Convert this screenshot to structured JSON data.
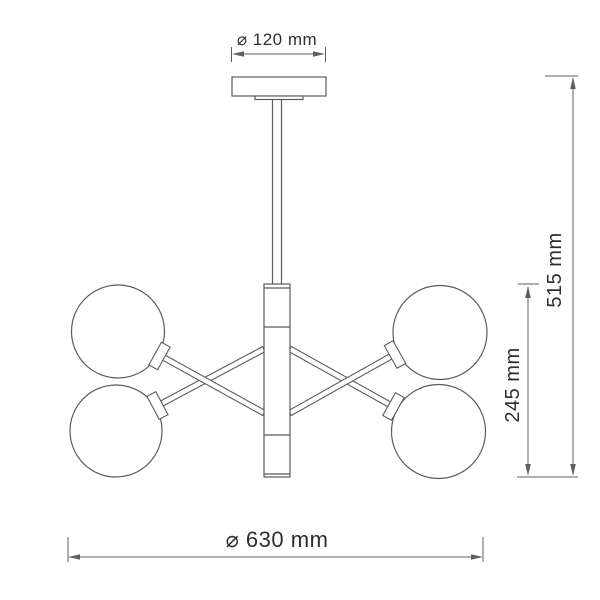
{
  "drawing": {
    "title": "Chandelier dimensional diagram",
    "type": "technical-line-drawing",
    "dimensions": {
      "canopy_diameter": "⌀ 120 mm",
      "total_height": "515 mm",
      "body_height": "245 mm",
      "fixture_diameter": "⌀ 630 mm"
    },
    "colors": {
      "line": "#5c5c5c",
      "dimension_line": "#5f5f5f",
      "text": "#2e2e2e",
      "background": "#ffffff"
    }
  }
}
